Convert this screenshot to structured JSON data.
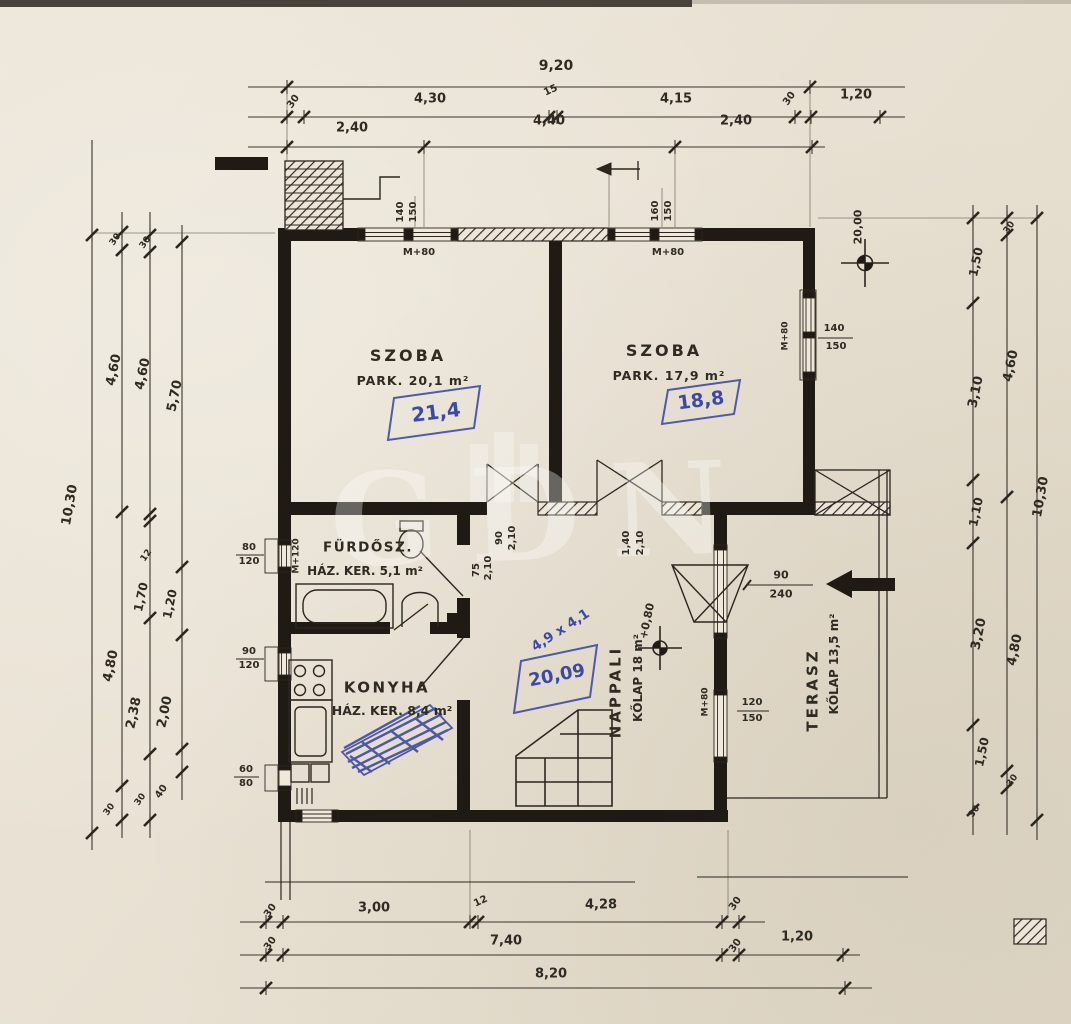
{
  "colors": {
    "paper": "#e9e2d4",
    "ink": "#2b261f",
    "blue_pen": "#3d4aa5",
    "wall": "#1f1a14"
  },
  "watermark": {
    "text": "GDN"
  },
  "rooms": {
    "szoba1": {
      "name": "SZOBA",
      "detail": "PARK. 20,1 m²",
      "annotation": "21,4"
    },
    "szoba2": {
      "name": "SZOBA",
      "detail": "PARK. 17,9 m²",
      "annotation": "18,8"
    },
    "furdoszoba": {
      "name": "FÜRDŐSZ.",
      "detail": "HÁZ. KER. 5,1 m²"
    },
    "konyha": {
      "name": "KONYHA",
      "detail": "HÁZ. KER. 8,4 m²"
    },
    "nappali": {
      "name": "NAPPALI",
      "detail": "KŐLAP 18 m²",
      "blue_dims": "4,9 x 4,1",
      "annotation": "20,09"
    },
    "terasz": {
      "name": "TERASZ",
      "detail": "KŐLAP 13,5 m²"
    }
  },
  "markers": {
    "terrace_level": "+0,80",
    "site_level": "20,00"
  },
  "dim_labels": [
    {
      "t": "9,20",
      "x": 556,
      "y": 66,
      "s": 14
    },
    {
      "t": "30",
      "x": 294,
      "y": 102,
      "r": -55,
      "s": 10
    },
    {
      "t": "4,30",
      "x": 430,
      "y": 99,
      "s": 13
    },
    {
      "t": "15",
      "x": 551,
      "y": 91,
      "r": -25,
      "s": 10
    },
    {
      "t": "4,15",
      "x": 676,
      "y": 99,
      "s": 13
    },
    {
      "t": "30",
      "x": 790,
      "y": 99,
      "r": -55,
      "s": 10
    },
    {
      "t": "1,20",
      "x": 856,
      "y": 95,
      "s": 13
    },
    {
      "t": "2,40",
      "x": 352,
      "y": 128,
      "s": 13
    },
    {
      "t": "4,40",
      "x": 549,
      "y": 121,
      "s": 13
    },
    {
      "t": "2,40",
      "x": 736,
      "y": 121,
      "s": 13
    },
    {
      "t": "30",
      "x": 271,
      "y": 911,
      "r": -55,
      "s": 10
    },
    {
      "t": "3,00",
      "x": 374,
      "y": 908,
      "s": 13
    },
    {
      "t": "12",
      "x": 481,
      "y": 902,
      "r": -25,
      "s": 10
    },
    {
      "t": "4,28",
      "x": 601,
      "y": 905,
      "s": 13
    },
    {
      "t": "30",
      "x": 736,
      "y": 904,
      "r": -55,
      "s": 10
    },
    {
      "t": "30",
      "x": 271,
      "y": 944,
      "r": -55,
      "s": 10
    },
    {
      "t": "7,40",
      "x": 506,
      "y": 941,
      "s": 13
    },
    {
      "t": "30",
      "x": 736,
      "y": 946,
      "r": -55,
      "s": 10
    },
    {
      "t": "1,20",
      "x": 797,
      "y": 937,
      "s": 13
    },
    {
      "t": "8,20",
      "x": 551,
      "y": 974,
      "s": 13
    },
    {
      "t": "10,30",
      "x": 70,
      "y": 505,
      "r": -80,
      "s": 13
    },
    {
      "t": "30",
      "x": 116,
      "y": 240,
      "r": -55,
      "s": 9
    },
    {
      "t": "4,60",
      "x": 114,
      "y": 370,
      "r": -78,
      "s": 13
    },
    {
      "t": "4,80",
      "x": 111,
      "y": 666,
      "r": -78,
      "s": 13
    },
    {
      "t": "30",
      "x": 110,
      "y": 810,
      "r": -55,
      "s": 9
    },
    {
      "t": "30",
      "x": 146,
      "y": 243,
      "r": -55,
      "s": 9
    },
    {
      "t": "4,60",
      "x": 143,
      "y": 374,
      "r": -78,
      "s": 13
    },
    {
      "t": "12",
      "x": 147,
      "y": 556,
      "r": -55,
      "s": 9
    },
    {
      "t": "1,70",
      "x": 141,
      "y": 597,
      "r": -78,
      "s": 12
    },
    {
      "t": "2,38",
      "x": 134,
      "y": 713,
      "r": -78,
      "s": 13
    },
    {
      "t": "30",
      "x": 141,
      "y": 800,
      "r": -55,
      "s": 9
    },
    {
      "t": "5,70",
      "x": 175,
      "y": 396,
      "r": -78,
      "s": 13
    },
    {
      "t": "1,20",
      "x": 170,
      "y": 604,
      "r": -78,
      "s": 12
    },
    {
      "t": "2,00",
      "x": 165,
      "y": 712,
      "r": -78,
      "s": 13
    },
    {
      "t": "40",
      "x": 162,
      "y": 792,
      "r": -55,
      "s": 10
    },
    {
      "t": "30",
      "x": 1010,
      "y": 228,
      "r": -55,
      "s": 9
    },
    {
      "t": "1,50",
      "x": 976,
      "y": 262,
      "r": -78,
      "s": 12
    },
    {
      "t": "3,10",
      "x": 976,
      "y": 392,
      "r": -78,
      "s": 13
    },
    {
      "t": "4,60",
      "x": 1011,
      "y": 366,
      "r": -78,
      "s": 13
    },
    {
      "t": "1,10",
      "x": 976,
      "y": 512,
      "r": -78,
      "s": 12
    },
    {
      "t": "3,20",
      "x": 979,
      "y": 634,
      "r": -78,
      "s": 13
    },
    {
      "t": "4,80",
      "x": 1015,
      "y": 650,
      "r": -78,
      "s": 13
    },
    {
      "t": "1,50",
      "x": 982,
      "y": 752,
      "r": -78,
      "s": 12
    },
    {
      "t": "30",
      "x": 1013,
      "y": 781,
      "r": -55,
      "s": 9
    },
    {
      "t": "30",
      "x": 975,
      "y": 812,
      "r": -55,
      "s": 9
    },
    {
      "t": "10,30",
      "x": 1041,
      "y": 497,
      "r": -80,
      "s": 13
    },
    {
      "t": "140",
      "x": 401,
      "y": 212,
      "r": -90,
      "s": 10
    },
    {
      "t": "150",
      "x": 414,
      "y": 212,
      "r": -90,
      "s": 10
    },
    {
      "t": "M+80",
      "x": 419,
      "y": 253,
      "s": 10
    },
    {
      "t": "160",
      "x": 656,
      "y": 211,
      "r": -90,
      "s": 10
    },
    {
      "t": "150",
      "x": 669,
      "y": 211,
      "r": -90,
      "s": 10
    },
    {
      "t": "M+80",
      "x": 668,
      "y": 253,
      "s": 10
    },
    {
      "t": "20,00",
      "x": 858,
      "y": 227,
      "r": -90,
      "s": 11,
      "n": "site-level-label"
    },
    {
      "t": "80",
      "x": 249,
      "y": 548,
      "s": 10
    },
    {
      "t": "120",
      "x": 249,
      "y": 562,
      "s": 10
    },
    {
      "t": "M+120",
      "x": 297,
      "y": 556,
      "r": -90,
      "s": 9
    },
    {
      "t": "90",
      "x": 249,
      "y": 652,
      "s": 10
    },
    {
      "t": "120",
      "x": 249,
      "y": 666,
      "s": 10
    },
    {
      "t": "60",
      "x": 246,
      "y": 770,
      "s": 10
    },
    {
      "t": "80",
      "x": 246,
      "y": 784,
      "s": 10
    },
    {
      "t": "75",
      "x": 477,
      "y": 570,
      "r": -90,
      "s": 10
    },
    {
      "t": "2,10",
      "x": 489,
      "y": 568,
      "r": -90,
      "s": 10
    },
    {
      "t": "90",
      "x": 500,
      "y": 538,
      "r": -90,
      "s": 10
    },
    {
      "t": "2,10",
      "x": 513,
      "y": 538,
      "r": -90,
      "s": 10
    },
    {
      "t": "1,40",
      "x": 627,
      "y": 543,
      "r": -90,
      "s": 10
    },
    {
      "t": "2,10",
      "x": 641,
      "y": 543,
      "r": -90,
      "s": 10
    },
    {
      "t": "90",
      "x": 781,
      "y": 575,
      "s": 11
    },
    {
      "t": "240",
      "x": 781,
      "y": 594,
      "s": 11
    },
    {
      "t": "120",
      "x": 752,
      "y": 703,
      "s": 10
    },
    {
      "t": "150",
      "x": 752,
      "y": 719,
      "s": 10
    },
    {
      "t": "M+80",
      "x": 706,
      "y": 702,
      "r": -90,
      "s": 9
    },
    {
      "t": "140",
      "x": 834,
      "y": 329,
      "s": 10
    },
    {
      "t": "150",
      "x": 836,
      "y": 347,
      "s": 10
    },
    {
      "t": "M+80",
      "x": 786,
      "y": 336,
      "r": -90,
      "s": 9
    },
    {
      "t": "+0,80",
      "x": 647,
      "y": 621,
      "r": -78,
      "s": 11,
      "n": "terrace-level-label"
    }
  ]
}
